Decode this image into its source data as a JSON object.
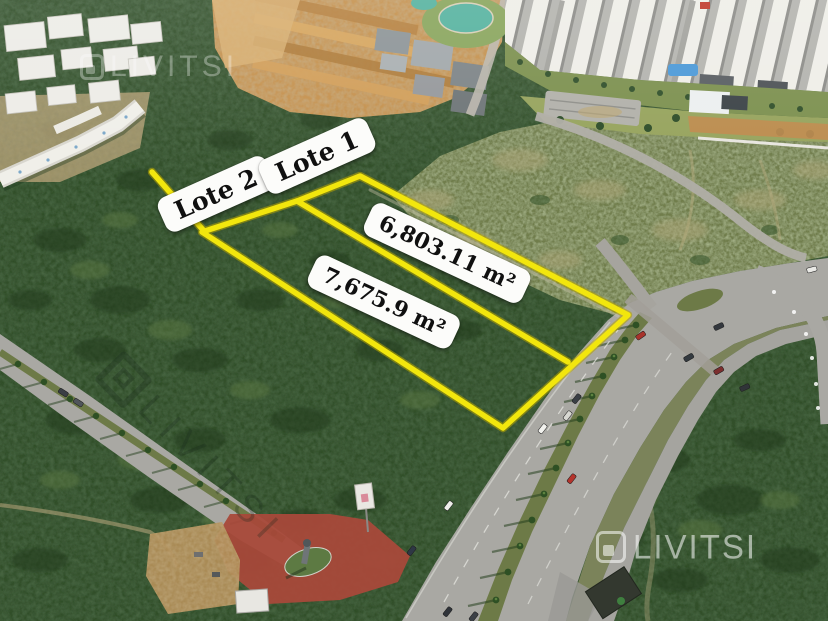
{
  "scene": {
    "description": "Aerial drone photo of land for sale: two lots outlined in yellow beside a divided avenue",
    "brand": "LIVITSI"
  },
  "lots": [
    {
      "label": "Lote 1",
      "area": "6,803.11 m²"
    },
    {
      "label": "Lote 2",
      "area": "7,675.9 m²"
    }
  ],
  "watermarks": {
    "top_left": "LIVITSI",
    "center_left": "LIVITSI",
    "bottom_right": "LIVITSI"
  },
  "colors": {
    "lot_boundary": "#f2e60d",
    "lot_boundary_edge": "#b7a500",
    "label_background": "#fcfcfa",
    "label_text": "#101010"
  }
}
